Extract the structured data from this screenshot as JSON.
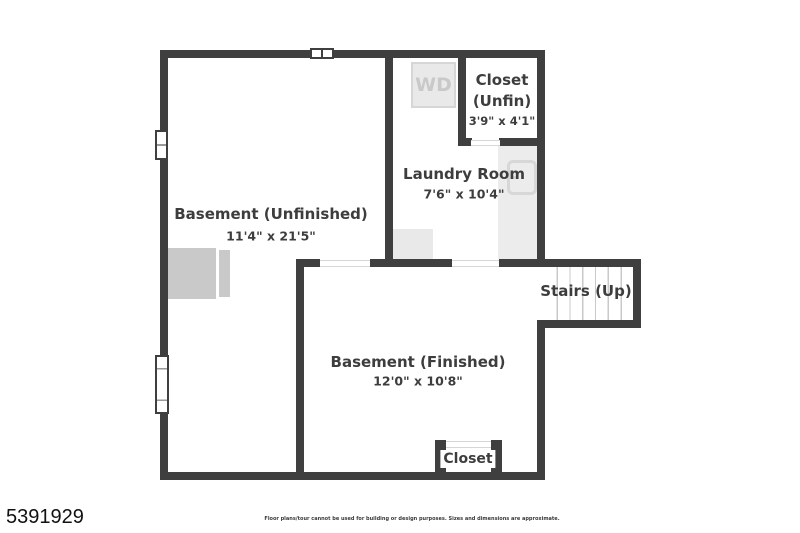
{
  "colors": {
    "wall": "#3f3f3f",
    "label_text": "#3d3d3d",
    "light_fill": "#e9e9e9",
    "furniture_fill": "#c9c9c9",
    "appliance_outline": "#d7d7d7",
    "background": "#ffffff"
  },
  "floorplan": {
    "rooms": {
      "basement_unfinished": {
        "name": "Basement (Unfinished)",
        "dims": "11'4\" x 21'5\""
      },
      "laundry": {
        "name": "Laundry Room",
        "dims": "7'6\" x 10'4\""
      },
      "closet_unfin": {
        "name_line1": "Closet",
        "name_line2": "(Unfin)",
        "dims": "3'9\" x 4'1\""
      },
      "basement_finished": {
        "name": "Basement (Finished)",
        "dims": "12'0\" x 10'8\""
      },
      "stairs": {
        "name": "Stairs (Up)"
      },
      "closet_small": {
        "name": "Closet"
      }
    },
    "appliances": {
      "washer_dryer": "WD"
    }
  },
  "footer": {
    "listing_number": "5391929",
    "disclaimer": "Floor plans/tour cannot be used for building or design purposes. Sizes and dimensions are approximate."
  }
}
